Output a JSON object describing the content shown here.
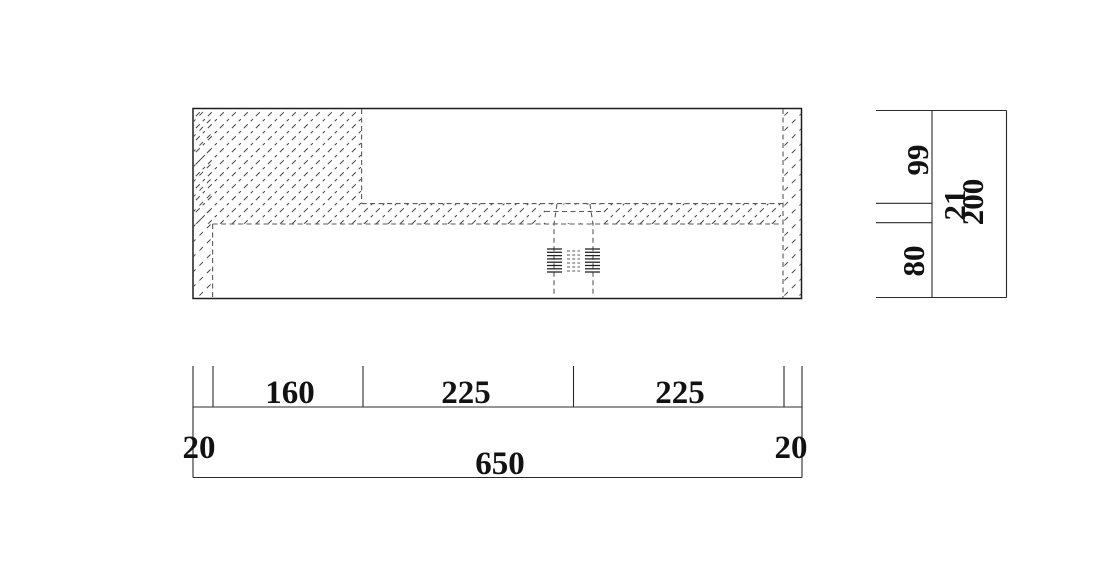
{
  "drawing": {
    "kind": "cad-section-drawing",
    "views": {
      "section_view": "basin-cross-section",
      "right_scale": "vertical-dimension-scale",
      "bottom_scale": "horizontal-dimension-scale"
    }
  },
  "dimensions": {
    "bottom": {
      "segments": [
        "20",
        "160",
        "225",
        "225",
        "20"
      ],
      "total": "650"
    },
    "right": {
      "segments": [
        "99",
        "21",
        "80"
      ],
      "total": "200"
    }
  },
  "colors": {
    "background": "#ffffff",
    "outline": "#1f1f1f",
    "hidden_line": "#5a5a5a",
    "hatch": "#454545",
    "text": "#121212"
  }
}
